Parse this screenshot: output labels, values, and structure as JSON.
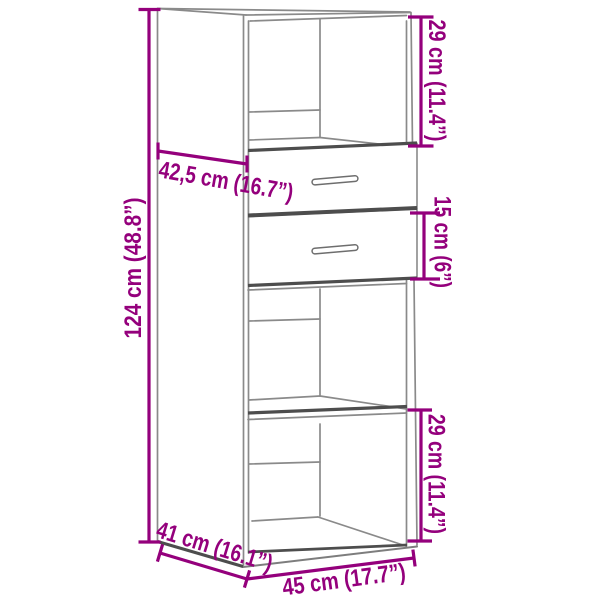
{
  "page": {
    "background": "#ffffff"
  },
  "drawing": {
    "description": "Axonometric line drawing of a highboard cabinet with an open top compartment, two drawers with bar handles, and two open shelf compartments below, annotated with dimension lines",
    "colors": {
      "dimension_accent": "#94007c",
      "outline_gray": "#8a8a8a",
      "outline_dark": "#4d4d4d",
      "background": "#ffffff"
    }
  },
  "dimensions": {
    "total_height": "124 cm (48.8”)",
    "top_compartment_height": "29 cm (11.4”)",
    "top_depth": "42,5 cm (16.7”)",
    "drawer_height": "15 cm (6”)",
    "bottom_compartment_height": "29 cm (11.4”)",
    "depth": "41 cm (16.1”)",
    "width": "45 cm (17.7”)"
  }
}
